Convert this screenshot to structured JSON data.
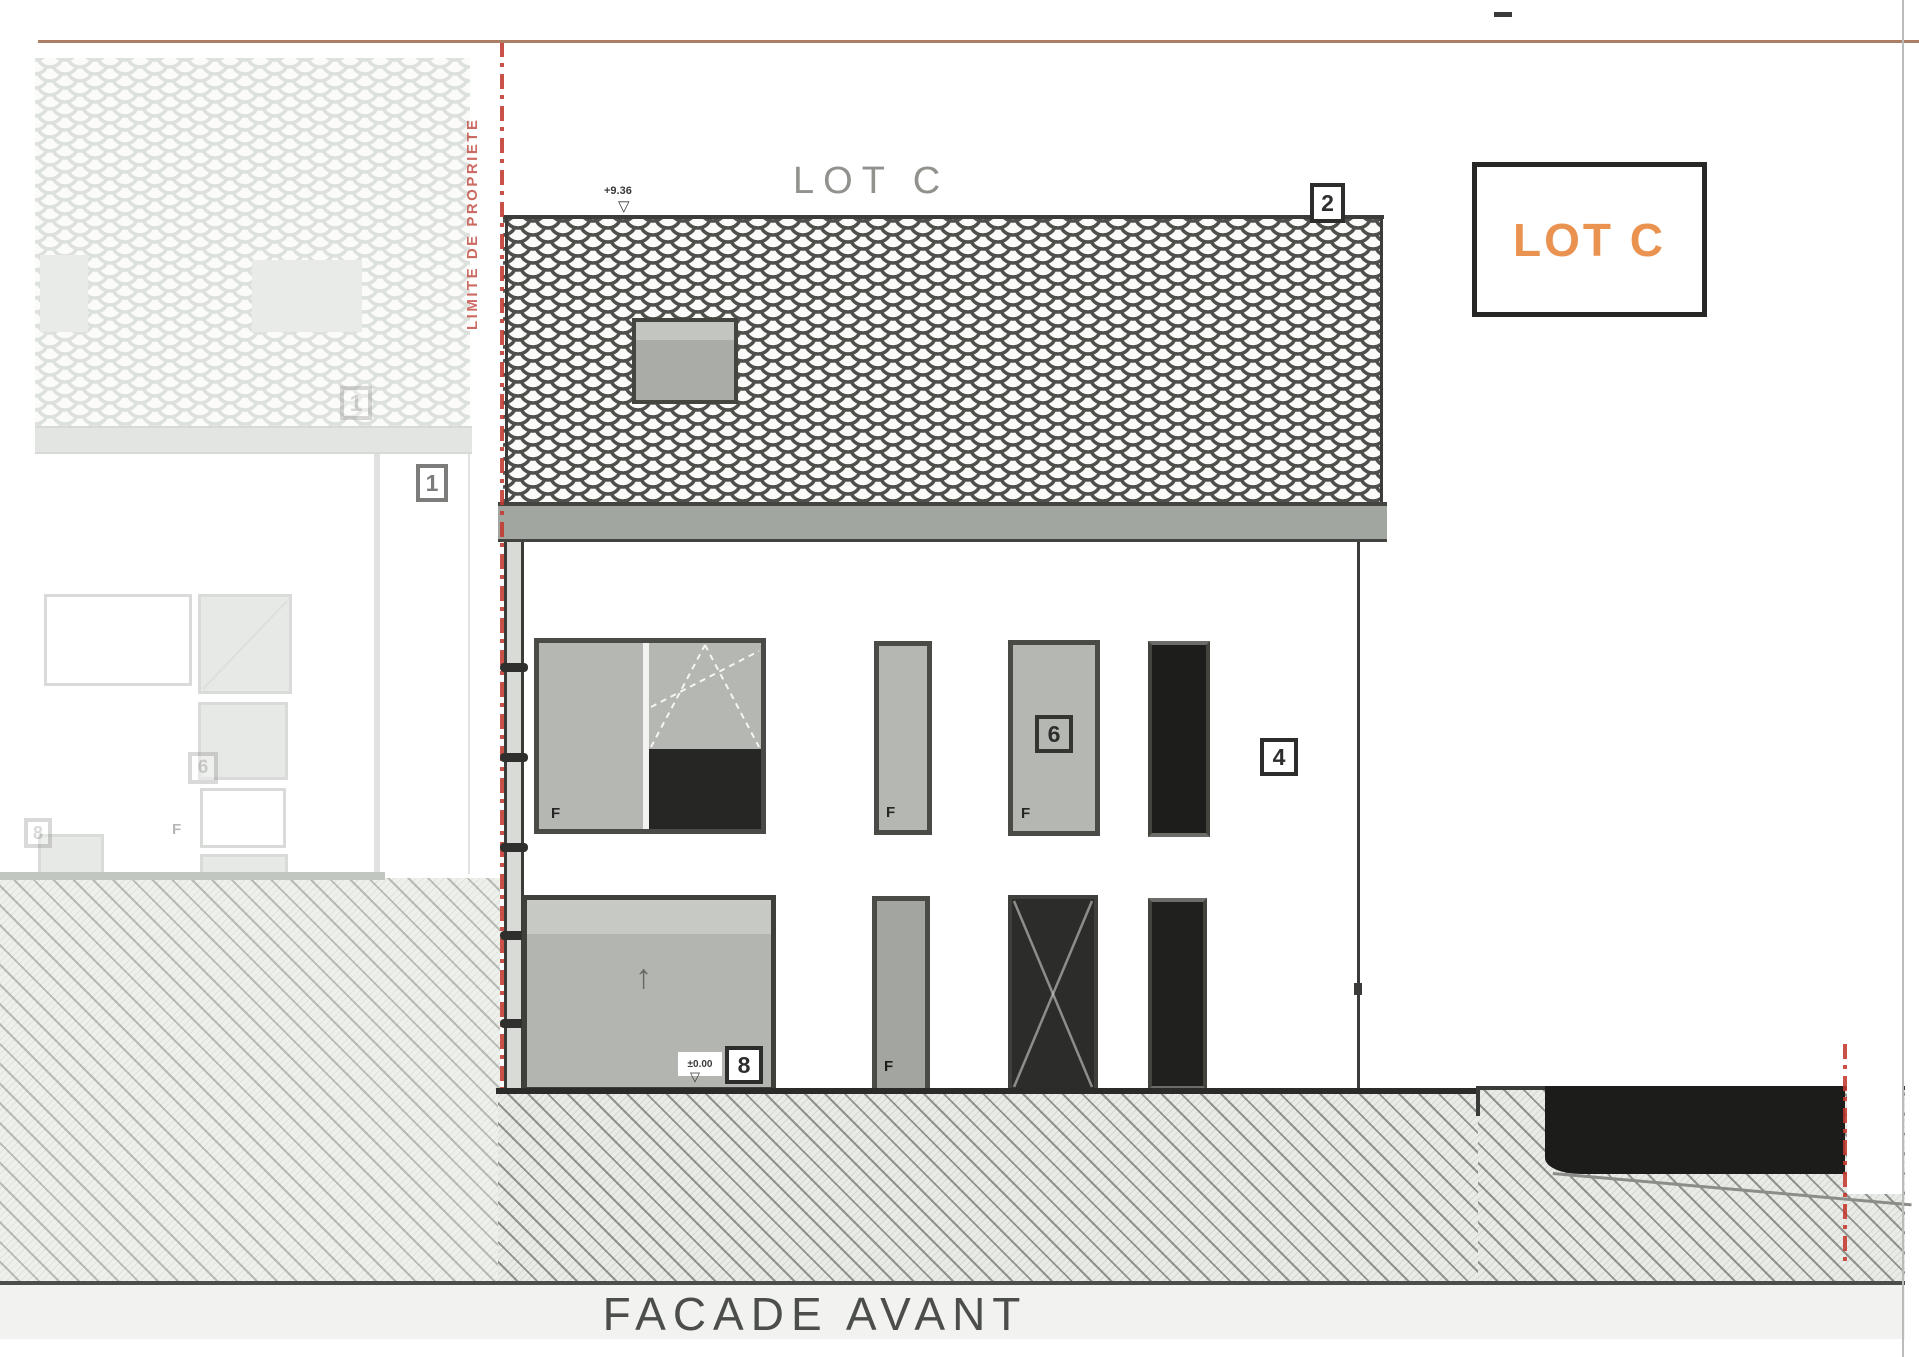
{
  "title": "FACADE AVANT",
  "lot": {
    "top_label": "LOT C",
    "legend_label": "LOT C"
  },
  "boundary": {
    "vertical_text": "LIMITE DE PROPRIETE"
  },
  "levels": {
    "ridge": "+9.36",
    "ground": "±0.00"
  },
  "markers": {
    "one": "1",
    "two": "2",
    "four": "4",
    "six": "6",
    "eight": "8"
  },
  "window_labels": {
    "fixed": "F"
  },
  "icons": {
    "level_triangle": "▽",
    "garage_arrow": "↑"
  },
  "colors": {
    "accent_orange": "#EA9250",
    "boundary_red": "#C3392F",
    "ink": "#3A3A38"
  }
}
